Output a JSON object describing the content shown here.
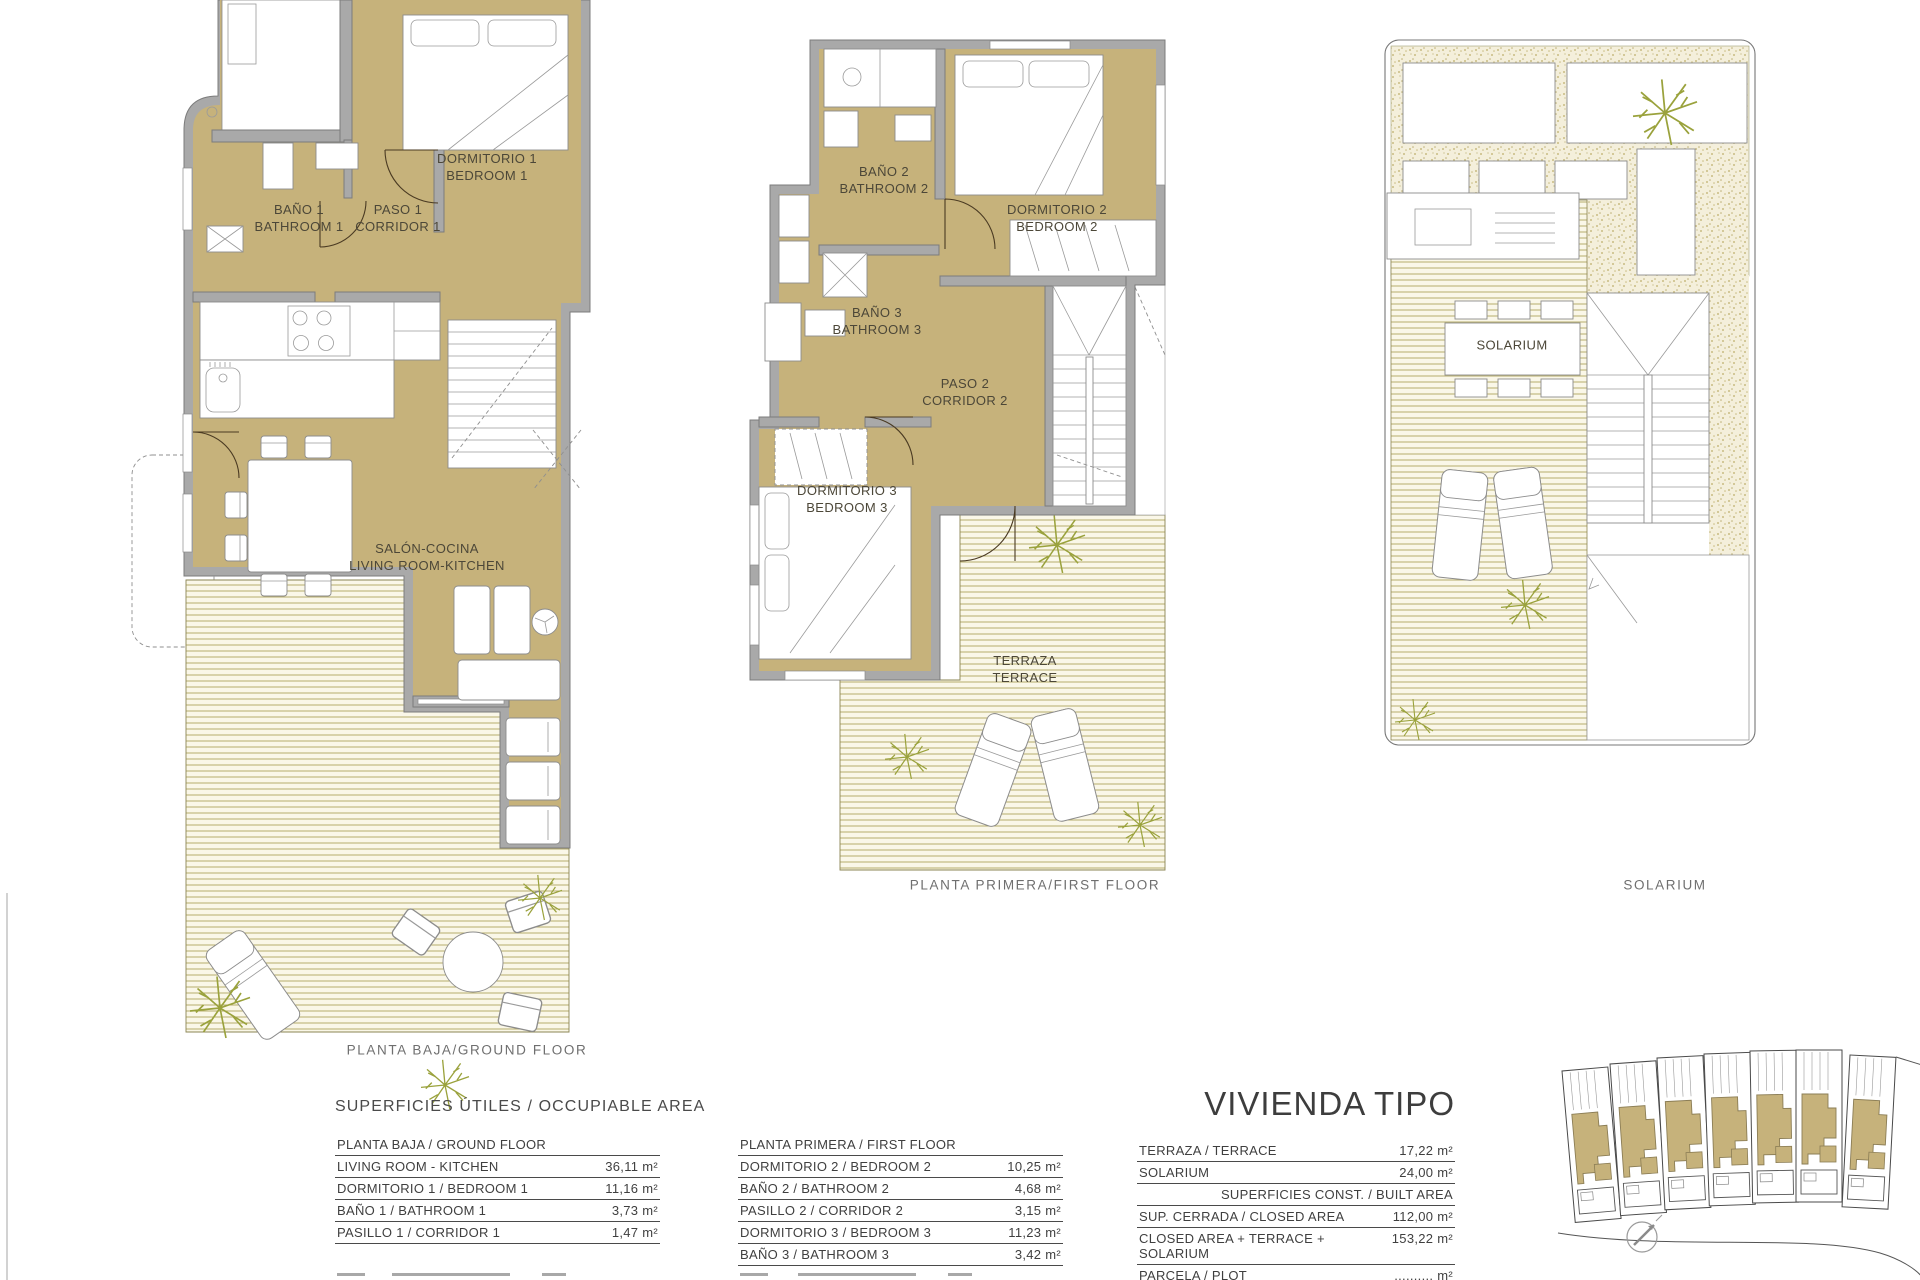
{
  "colors": {
    "room_fill": "#c6b27b",
    "wall_gray": "#a9a9a9",
    "deck_line": "#b7ad6d",
    "deck_bg": "#faf7e8",
    "stipple_dot": "#c9bc82",
    "stipple_bg": "#f4efdb",
    "plant_olive": "#9aa23c"
  },
  "plans": {
    "ground": {
      "caption": "PLANTA BAJA/GROUND FLOOR",
      "labels": {
        "bath": {
          "es": "BAÑO 1",
          "en": "BATHROOM 1"
        },
        "corridor": {
          "es": "PASO 1",
          "en": "CORRIDOR 1"
        },
        "bedroom": {
          "es": "DORMITORIO 1",
          "en": "BEDROOM 1"
        },
        "living": {
          "es": "SALÓN-COCINA",
          "en": "LIVING ROOM-KITCHEN"
        }
      }
    },
    "first": {
      "caption": "PLANTA PRIMERA/FIRST FLOOR",
      "labels": {
        "bath2": {
          "es": "BAÑO 2",
          "en": "BATHROOM 2"
        },
        "bedroom2": {
          "es": "DORMITORIO 2",
          "en": "BEDROOM 2"
        },
        "bath3": {
          "es": "BAÑO 3",
          "en": "BATHROOM 3"
        },
        "corridor2": {
          "es": "PASO 2",
          "en": "CORRIDOR 2"
        },
        "bedroom3": {
          "es": "DORMITORIO 3",
          "en": "BEDROOM 3"
        },
        "terrace": {
          "es": "TERRAZA",
          "en": "TERRACE"
        }
      }
    },
    "solarium": {
      "caption": "SOLARIUM",
      "label": "SOLARIUM"
    }
  },
  "tables": {
    "occupiable": {
      "title": "SUPERFICIES ÚTILES / OCCUPIABLE AREA",
      "ground": {
        "header": "PLANTA BAJA / GROUND FLOOR",
        "rows": [
          {
            "label": "LIVING ROOM - KITCHEN",
            "value": "36,11 m²"
          },
          {
            "label": "DORMITORIO 1 / BEDROOM 1",
            "value": "11,16 m²"
          },
          {
            "label": "BAÑO 1 / BATHROOM 1",
            "value": "3,73 m²"
          },
          {
            "label": "PASILLO 1 / CORRIDOR 1",
            "value": "1,47 m²"
          }
        ]
      },
      "first": {
        "header": "PLANTA PRIMERA / FIRST FLOOR",
        "rows": [
          {
            "label": "DORMITORIO 2 / BEDROOM 2",
            "value": "10,25 m²"
          },
          {
            "label": "BAÑO 2 / BATHROOM 2",
            "value": "4,68 m²"
          },
          {
            "label": "PASILLO 2 / CORRIDOR 2",
            "value": "3,15 m²"
          },
          {
            "label": "DORMITORIO 3 / BEDROOM 3",
            "value": "11,23 m²"
          },
          {
            "label": "BAÑO 3 / BATHROOM 3",
            "value": "3,42 m²"
          }
        ]
      }
    },
    "vivienda": {
      "title": "VIVIENDA TIPO",
      "rows": [
        {
          "label": "TERRAZA / TERRACE",
          "value": "17,22 m²"
        },
        {
          "label": "SOLARIUM",
          "value": "24,00 m²"
        }
      ],
      "subheader": "SUPERFICIES  CONST. / BUILT AREA",
      "rows2": [
        {
          "label": "SUP. CERRADA / CLOSED AREA",
          "value": "112,00 m²"
        },
        {
          "label": "CLOSED AREA + TERRACE + SOLARIUM",
          "value": "153,22 m²"
        },
        {
          "label": "PARCELA / PLOT",
          "value": ".......... m²"
        }
      ]
    }
  }
}
